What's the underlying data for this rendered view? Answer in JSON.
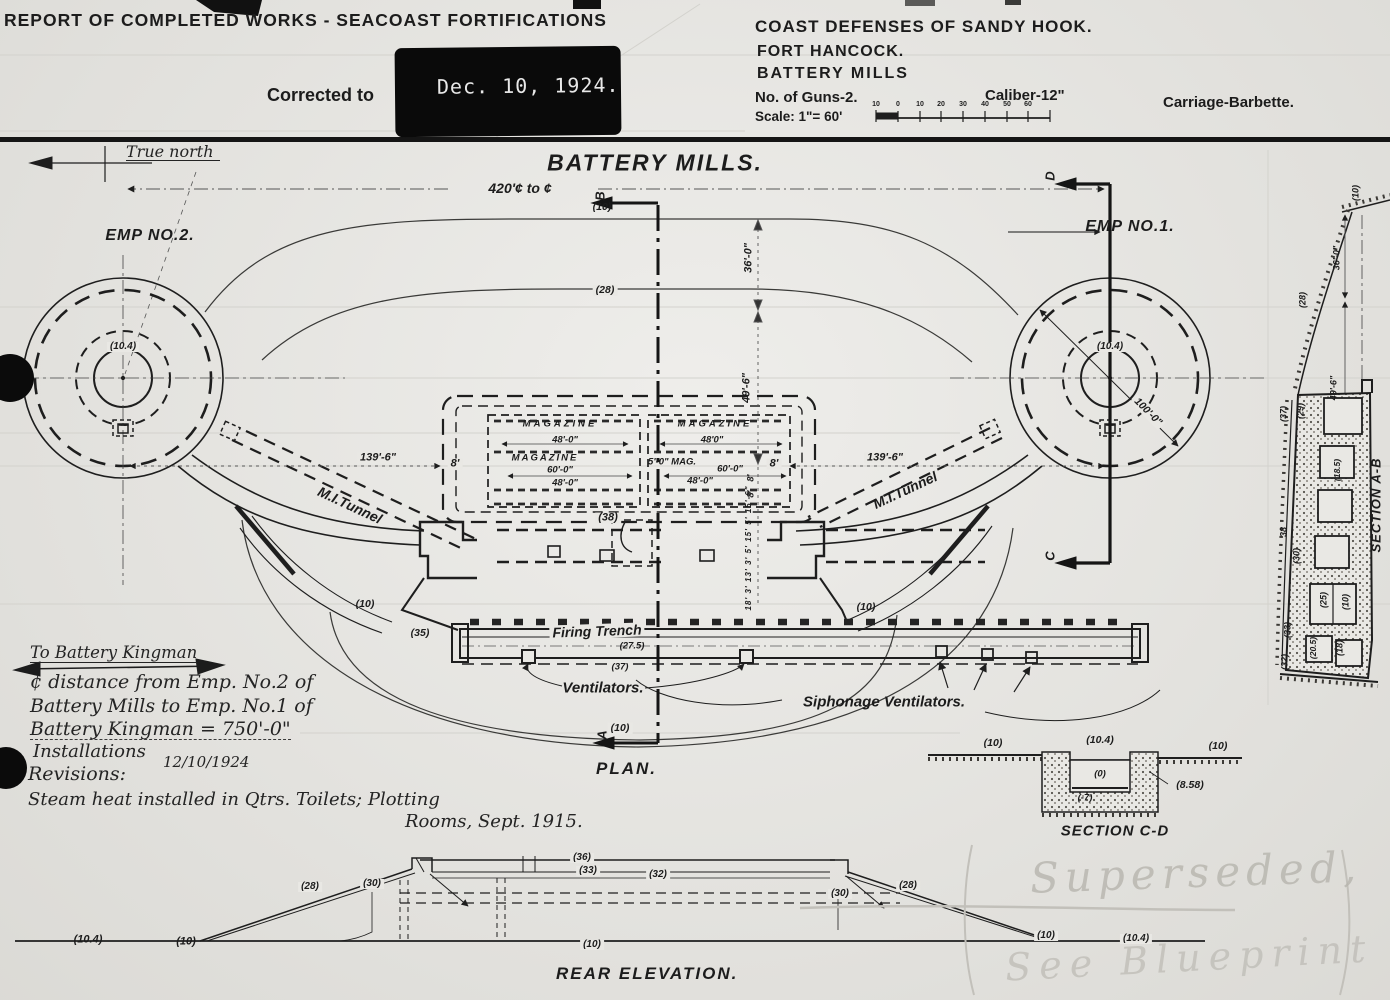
{
  "header": {
    "report_title": "REPORT OF COMPLETED WORKS - SEACOAST FORTIFICATIONS",
    "corrected_label": "Corrected to",
    "corrected_date": "Dec. 10, 1924.",
    "district": "COAST DEFENSES OF SANDY HOOK.",
    "fort": "FORT HANCOCK.",
    "battery": "BATTERY MILLS",
    "guns": "No. of Guns-2.",
    "caliber": "Caliber-12\"",
    "carriage": "Carriage-Barbette.",
    "scale_label": "Scale: 1\"= 60'",
    "scale_ticks": [
      "10",
      "0",
      "10",
      "20",
      "30",
      "40",
      "50",
      "60"
    ]
  },
  "title": "BATTERY MILLS.",
  "compass": {
    "true_north": "True north"
  },
  "plan": {
    "title": "PLAN.",
    "emp2": "EMP NO.2.",
    "emp1": "EMP NO.1.",
    "dim_420": "420'¢ to ¢",
    "elev_10_top": "(10)",
    "elev_28": "(28)",
    "emp2_crest": "(10.4)",
    "emp1_crest": "(10.4)",
    "dim_100": "100'-0\"",
    "dim_139_left": "139'-6\"",
    "dim_139_right": "139'-6\"",
    "tunnel_left": "M.I.Tunnel",
    "tunnel_right": "M.I.Tunnel",
    "dim_8_left": "8'",
    "dim_8_right": "8'",
    "dim_36": "36'-0\"",
    "dim_49": "49'-6\"",
    "dim_8a": "8'",
    "dim_8b": "8'",
    "room_dims": "18' 3' 13' 3' 5' 15' 5' 15'-6\"",
    "mag_left_1": "MAGAZINE",
    "mag_left_1_dim": "48'-0\"",
    "mag_left_2": "MAGAZINE",
    "mag_left_2_dim_a": "60'-0\"",
    "mag_left_2_dim_b": "48'-0\"",
    "mag_right_1": "MAGAZINE",
    "mag_right_1_dim": "48'0\"",
    "mag_right_2": "5'-0\" MAG.",
    "mag_right_2_dim_a": "60'-0\"",
    "mag_right_2_dim_b": "48'-0\"",
    "elev_38": "(38)",
    "marker_a": "A",
    "marker_b": "B",
    "marker_c": "C",
    "marker_d": "D",
    "elev_10_trench_left": "(10)",
    "elev_10_trench_right": "(10)",
    "elev_35": "(35)",
    "firing_trench": "Firing Trench",
    "trench_275": "(27.5)",
    "trench_37": "(37)",
    "ventilators": "Ventilators.",
    "siphonage": "Siphonage Ventilators.",
    "elev_10_bottom": "(10)"
  },
  "notes": {
    "kingman": "To Battery Kingman",
    "line1": "¢ distance from Emp. No.2 of",
    "line2": "Battery Mills to Emp. No.1 of",
    "line3": "Battery Kingman = 750'-0\"",
    "line4": "Installations",
    "line5": "Revisions:",
    "revision_date": "12/10/1924",
    "steam1": "Steam heat installed in Qtrs. Toilets; Plotting",
    "steam2": "Rooms, Sept. 1915."
  },
  "section_cd": {
    "title": "SECTION C-D",
    "e10_left": "(10)",
    "e104": "(10.4)",
    "e10_right": "(10)",
    "e0": "(0)",
    "em7": "(-7)",
    "e858": "(8.58)"
  },
  "section_ab": {
    "title": "SECTION A-B",
    "e10_top": "(10)",
    "dim_36": "36'-0\"",
    "dim_49": "49'-6\"",
    "e28": "(28)",
    "e29": "(29)",
    "e37": "(37)",
    "e38": "38",
    "e30": "(30)",
    "e185": "(18.5)",
    "e25": "(25)",
    "e10": "(10)",
    "e205": "(20.5)",
    "e18": "(18)",
    "e33": "(33)",
    "e32": "(32)"
  },
  "rear": {
    "title": "REAR ELEVATION.",
    "e104_left": "(10.4)",
    "e10_left": "(10)",
    "e28_left": "(28)",
    "e30_left": "(30)",
    "e36": "(36)",
    "e33": "(33)",
    "e32": "(32)",
    "e30_right": "(30)",
    "e28_right": "(28)",
    "e10_center": "(10)",
    "e10_right": "(10)",
    "e104_right": "(10.4)"
  },
  "watermark": {
    "line1": "Superseded,",
    "line2": "See Blueprint"
  }
}
